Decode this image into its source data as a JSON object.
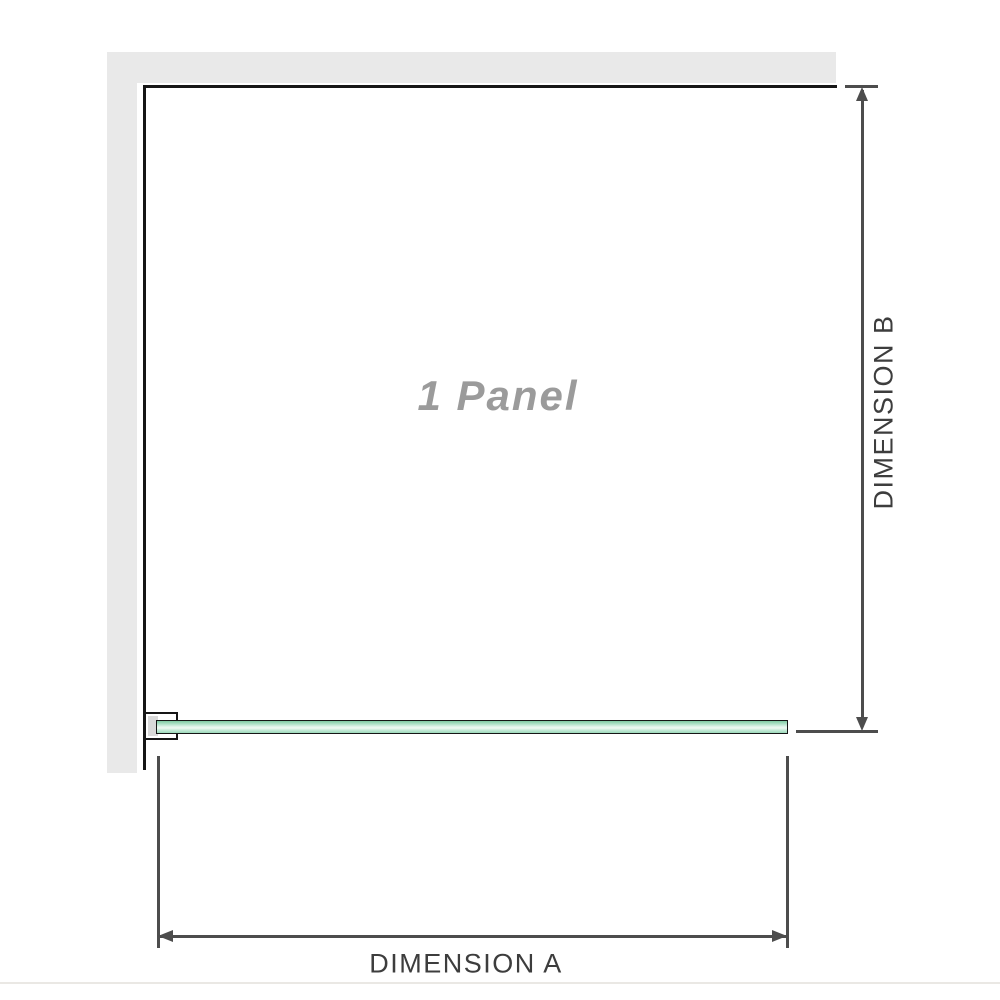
{
  "diagram": {
    "panel_label": "1 Panel",
    "dimension_a_label": "DIMENSION A",
    "dimension_b_label": "DIMENSION B",
    "colors": {
      "wall_fill": "#e9e9e9",
      "outline": "#161616",
      "dimension_line": "#4d4d4d",
      "dimension_label_text": "#3d3d3d",
      "panel_label_text": "#9b9b9b",
      "glass_green_dark": "#7fcaa3",
      "glass_green_mid": "#a9dfc3",
      "glass_green_light": "#f0faf4",
      "bracket_inset_fill": "#d9d9d9"
    }
  }
}
